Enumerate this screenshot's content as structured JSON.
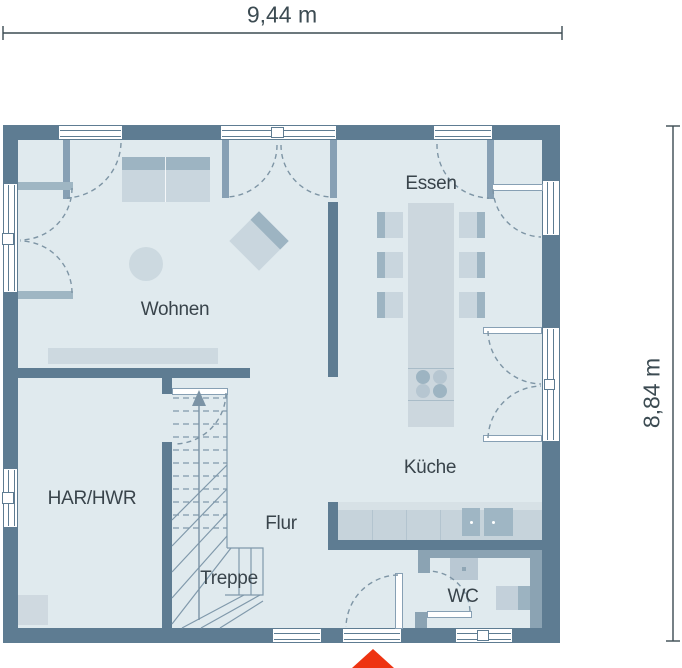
{
  "dimensions": {
    "width_label": "9,44 m",
    "height_label": "8,84 m"
  },
  "rooms": {
    "wohnen": "Wohnen",
    "essen": "Essen",
    "kueche": "Küche",
    "har_hwr": "HAR/HWR",
    "flur": "Flur",
    "treppe": "Treppe",
    "wc": "WC"
  },
  "colors": {
    "wall": "#5e7c92",
    "wall_light": "#8ba3b3",
    "floor": "#e0eaee",
    "furn": "#c9d6de",
    "furn_dark": "#9db4c2",
    "counter": "#c6d3db",
    "counter_top": "#d7e1e6",
    "sink": "#9fb6c4",
    "line": "#7e95a5",
    "dim": "#3c4b52",
    "text": "#39444b",
    "marker": "#ee3311",
    "leaf": "#87a0b4",
    "leaf_light": "#9fb6c3"
  }
}
